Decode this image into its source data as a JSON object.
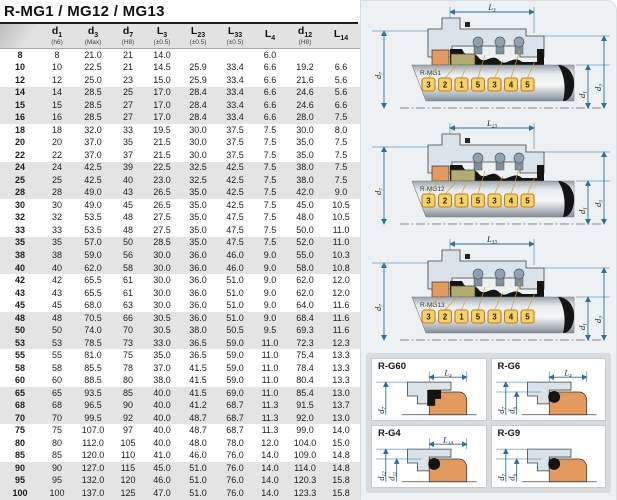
{
  "page": {
    "title": "R-MG1 / MG12 / MG13"
  },
  "table": {
    "columns": [
      {
        "main": "",
        "sub": "",
        "note": ""
      },
      {
        "main": "d",
        "sub": "1",
        "note": "(h6)"
      },
      {
        "main": "d",
        "sub": "3",
        "note": "(Max)"
      },
      {
        "main": "d",
        "sub": "7",
        "note": "(H8)"
      },
      {
        "main": "L",
        "sub": "3",
        "note": "(±0.5)"
      },
      {
        "main": "L",
        "sub": "23",
        "note": "(±0.5)"
      },
      {
        "main": "L",
        "sub": "33",
        "note": "(±0.5)"
      },
      {
        "main": "L",
        "sub": "4",
        "note": ""
      },
      {
        "main": "d",
        "sub": "12",
        "note": "(H8)"
      },
      {
        "main": "L",
        "sub": "14",
        "note": ""
      }
    ],
    "rows": [
      [
        "8",
        "8",
        "21.0",
        "21",
        "14.0",
        "",
        "",
        "6.0",
        "",
        ""
      ],
      [
        "10",
        "10",
        "22.5",
        "21",
        "14.5",
        "25.9",
        "33.4",
        "6.6",
        "19.2",
        "6.6"
      ],
      [
        "12",
        "12",
        "25.0",
        "23",
        "15.0",
        "25.9",
        "33.4",
        "6.6",
        "21.6",
        "5.6"
      ],
      [
        "14",
        "14",
        "28.5",
        "25",
        "17.0",
        "28.4",
        "33.4",
        "6.6",
        "24.6",
        "5.6"
      ],
      [
        "15",
        "15",
        "28.5",
        "27",
        "17.0",
        "28.4",
        "33.4",
        "6.6",
        "24.6",
        "6.6"
      ],
      [
        "16",
        "16",
        "28.5",
        "27",
        "17.0",
        "28.4",
        "33.4",
        "6.6",
        "28.0",
        "7.5"
      ],
      [
        "18",
        "18",
        "32.0",
        "33",
        "19.5",
        "30.0",
        "37.5",
        "7.5",
        "30.0",
        "8.0"
      ],
      [
        "20",
        "20",
        "37.0",
        "35",
        "21.5",
        "30.0",
        "37.5",
        "7.5",
        "35.0",
        "7.5"
      ],
      [
        "22",
        "22",
        "37.0",
        "37",
        "21.5",
        "30.0",
        "37.5",
        "7.5",
        "35.0",
        "7.5"
      ],
      [
        "24",
        "24",
        "42.5",
        "39",
        "22.5",
        "32.5",
        "42.5",
        "7.5",
        "38.0",
        "7.5"
      ],
      [
        "25",
        "25",
        "42.5",
        "40",
        "23.0",
        "32.5",
        "42.5",
        "7.5",
        "38.0",
        "7.5"
      ],
      [
        "28",
        "28",
        "49.0",
        "43",
        "26.5",
        "35.0",
        "42.5",
        "7.5",
        "42.0",
        "9.0"
      ],
      [
        "30",
        "30",
        "49.0",
        "45",
        "26.5",
        "35.0",
        "42.5",
        "7.5",
        "45.0",
        "10.5"
      ],
      [
        "32",
        "32",
        "53.5",
        "48",
        "27.5",
        "35.0",
        "47.5",
        "7.5",
        "48.0",
        "10.5"
      ],
      [
        "33",
        "33",
        "53.5",
        "48",
        "27.5",
        "35.0",
        "47.5",
        "7.5",
        "50.0",
        "11.0"
      ],
      [
        "35",
        "35",
        "57.0",
        "50",
        "28.5",
        "35.0",
        "47.5",
        "7.5",
        "52.0",
        "11.0"
      ],
      [
        "38",
        "38",
        "59.0",
        "56",
        "30.0",
        "36.0",
        "46.0",
        "9.0",
        "55.0",
        "10.3"
      ],
      [
        "40",
        "40",
        "62.0",
        "58",
        "30.0",
        "36.0",
        "46.0",
        "9.0",
        "58.0",
        "10.8"
      ],
      [
        "42",
        "42",
        "65.5",
        "61",
        "30.0",
        "36.0",
        "51.0",
        "9.0",
        "62.0",
        "12.0"
      ],
      [
        "43",
        "43",
        "65.5",
        "61",
        "30.0",
        "36.0",
        "51.0",
        "9.0",
        "62.0",
        "12.0"
      ],
      [
        "45",
        "45",
        "68.0",
        "63",
        "30.0",
        "36.0",
        "51.0",
        "9.0",
        "64.0",
        "11.6"
      ],
      [
        "48",
        "48",
        "70.5",
        "66",
        "30.5",
        "36.0",
        "51.0",
        "9.0",
        "68.4",
        "11.6"
      ],
      [
        "50",
        "50",
        "74.0",
        "70",
        "30.5",
        "38.0",
        "50.5",
        "9.5",
        "69.3",
        "11.6"
      ],
      [
        "53",
        "53",
        "78.5",
        "73",
        "33.0",
        "36.5",
        "59.0",
        "11.0",
        "72.3",
        "12.3"
      ],
      [
        "55",
        "55",
        "81.0",
        "75",
        "35.0",
        "36.5",
        "59.0",
        "11.0",
        "75.4",
        "13.3"
      ],
      [
        "58",
        "58",
        "85.5",
        "78",
        "37.0",
        "41.5",
        "59.0",
        "11.0",
        "78.4",
        "13.3"
      ],
      [
        "60",
        "60",
        "88.5",
        "80",
        "38.0",
        "41.5",
        "59.0",
        "11.0",
        "80.4",
        "13.3"
      ],
      [
        "65",
        "65",
        "93.5",
        "85",
        "40.0",
        "41.5",
        "69.0",
        "11.0",
        "85.4",
        "13.0"
      ],
      [
        "68",
        "68",
        "96.5",
        "90",
        "40.0",
        "41.2",
        "68.7",
        "11.3",
        "91.5",
        "13.7"
      ],
      [
        "70",
        "70",
        "99.5",
        "92",
        "40.0",
        "48.7",
        "68.7",
        "11.3",
        "92.0",
        "13.0"
      ],
      [
        "75",
        "75",
        "107.0",
        "97",
        "40.0",
        "48.7",
        "68.7",
        "11.3",
        "99.0",
        "14.0"
      ],
      [
        "80",
        "80",
        "112.0",
        "105",
        "40.0",
        "48.0",
        "78.0",
        "12.0",
        "104.0",
        "15.0"
      ],
      [
        "85",
        "85",
        "120.0",
        "110",
        "41.0",
        "46.0",
        "76.0",
        "14.0",
        "109.0",
        "14.8"
      ],
      [
        "90",
        "90",
        "127.0",
        "115",
        "45.0",
        "51.0",
        "76.0",
        "14.0",
        "114.0",
        "14.8"
      ],
      [
        "95",
        "95",
        "132.0",
        "120",
        "46.0",
        "51.0",
        "76.0",
        "14.0",
        "120.3",
        "15.8"
      ],
      [
        "100",
        "100",
        "137.0",
        "125",
        "47.0",
        "51.0",
        "76.0",
        "14.0",
        "123.3",
        "15.8"
      ]
    ]
  },
  "diagram_panel": {
    "main_diagrams": [
      {
        "name": "R-MG1",
        "length_dim": {
          "main": "L",
          "sub": "3"
        },
        "left_dim": {
          "main": "d",
          "sub": "7"
        },
        "right_dims": [
          {
            "main": "d",
            "sub": "1"
          },
          {
            "main": "d",
            "sub": "3"
          }
        ],
        "callouts": [
          "3",
          "2",
          "1",
          "5",
          "3",
          "4",
          "5"
        ]
      },
      {
        "name": "R-MG12",
        "length_dim": {
          "main": "L",
          "sub": "23"
        },
        "left_dim": {
          "main": "d",
          "sub": "7"
        },
        "right_dims": [
          {
            "main": "d",
            "sub": "1"
          },
          {
            "main": "d",
            "sub": "3"
          }
        ],
        "callouts": [
          "3",
          "2",
          "1",
          "5",
          "3",
          "4",
          "5"
        ]
      },
      {
        "name": "R-MG13",
        "length_dim": {
          "main": "L",
          "sub": "33"
        },
        "left_dim": {
          "main": "d",
          "sub": "7"
        },
        "right_dims": [
          {
            "main": "d",
            "sub": "1"
          },
          {
            "main": "d",
            "sub": "3"
          }
        ],
        "callouts": [
          "3",
          "2",
          "1",
          "5",
          "3",
          "4",
          "5"
        ]
      }
    ],
    "variant_cards": [
      {
        "name": "R-G60",
        "top_dim": {
          "main": "L",
          "sub": "4"
        },
        "left_dims": [
          {
            "main": "d",
            "sub": "7"
          }
        ],
        "seal_style": "block"
      },
      {
        "name": "R-G6",
        "top_dim": {
          "main": "L",
          "sub": "4"
        },
        "left_dims": [
          {
            "main": "d",
            "sub": "7"
          },
          {
            "main": "d",
            "sub": "6"
          }
        ],
        "seal_style": "oring"
      },
      {
        "name": "R-G4",
        "top_dim": {
          "main": "L",
          "sub": "14"
        },
        "left_dims": [
          {
            "main": "d",
            "sub": "12"
          },
          {
            "main": "d",
            "sub": "11"
          }
        ],
        "seal_style": "oring"
      },
      {
        "name": "R-G9",
        "top_dim": null,
        "left_dims": [
          {
            "main": "d",
            "sub": "7"
          },
          {
            "main": "d",
            "sub": "6"
          }
        ],
        "seal_style": "oring"
      }
    ]
  },
  "colors": {
    "dimension_blue": "#2a6f9e",
    "elastomer_orange": "#e29a5e",
    "seat_olive": "#b2ac73",
    "callout_yellow": "#f6d368",
    "callout_border": "#c3791b",
    "housing_gray": "#dbe3ea",
    "row_band_gray": "#e4e4e4",
    "header_gray": "#e2e2e2"
  }
}
